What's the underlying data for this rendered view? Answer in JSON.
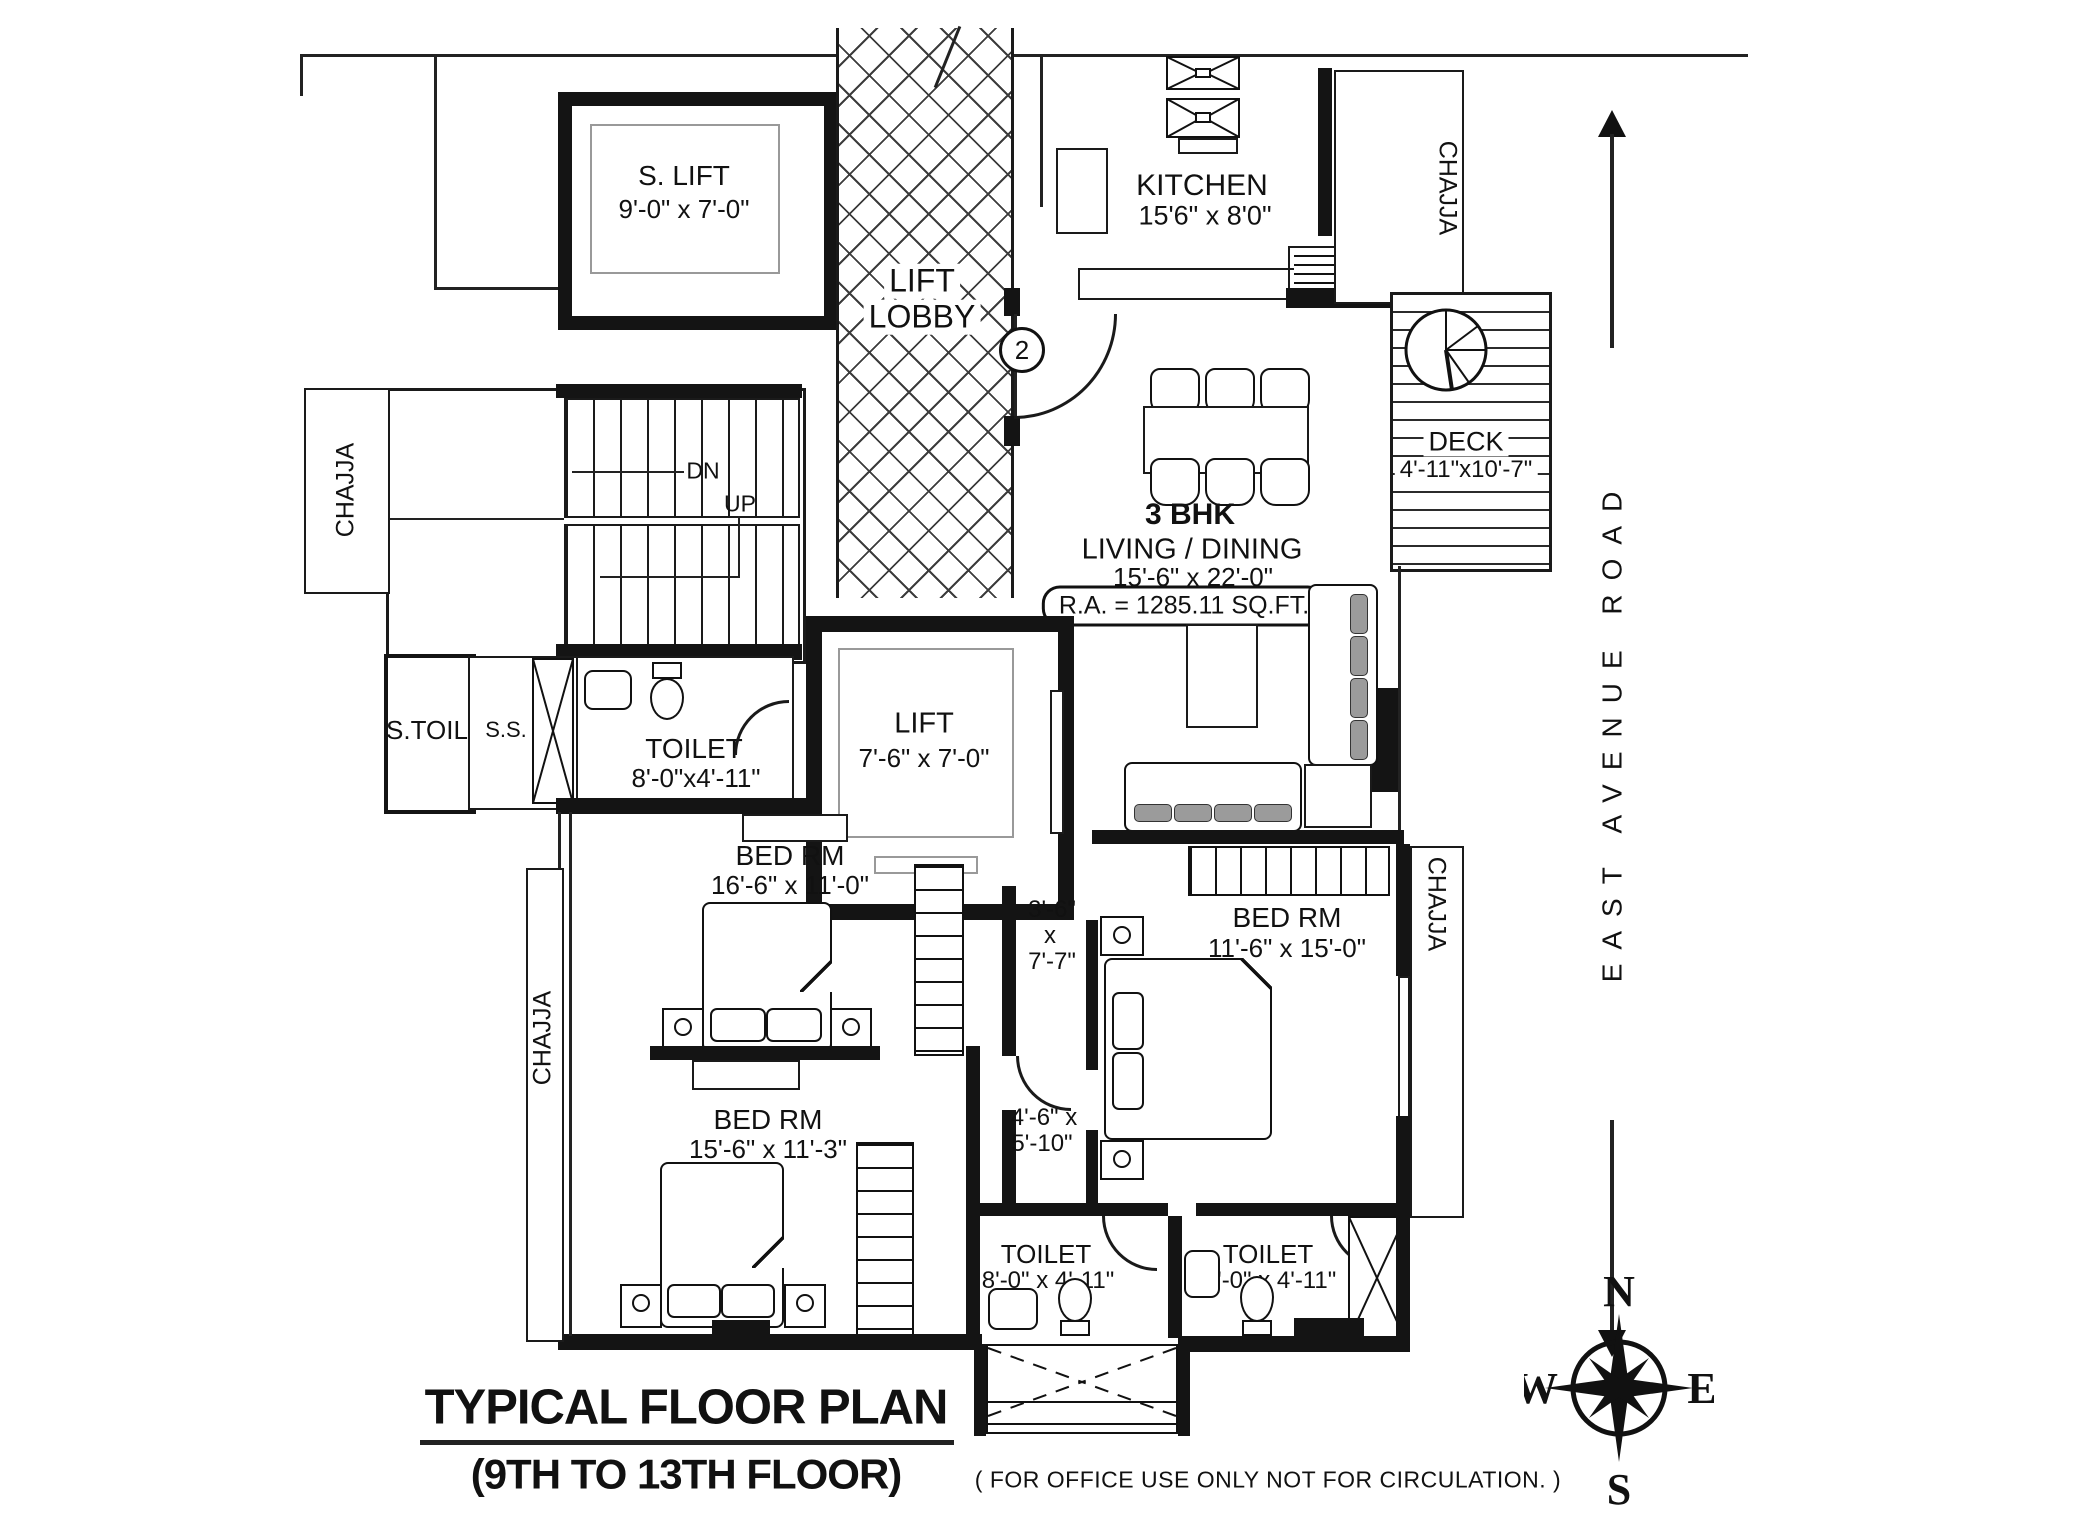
{
  "plan": {
    "s_lift": {
      "name": "S. LIFT",
      "dim": "9'-0\" x 7'-0\""
    },
    "lift_lobby": {
      "line1": "LIFT",
      "line2": "LOBBY"
    },
    "kitchen": {
      "name": "KITCHEN",
      "dim": "15'6\" x 8'0\""
    },
    "deck": {
      "name": "DECK",
      "dim": "4'-11\"x10'-7\""
    },
    "unit_type": "3 BHK",
    "living": {
      "name": "LIVING / DINING",
      "dim": "15'-6\" x 22'-0\"",
      "area": "R.A. = 1285.11 SQ.FT."
    },
    "lift": {
      "name": "LIFT",
      "dim": "7'-6\" x 7'-0\""
    },
    "toilet": {
      "name": "TOILET",
      "dim_mid": "8'-0\"x4'-11\"",
      "dim_small": "8'-0\" x 4'-11\""
    },
    "s_toil": "S.TOIL",
    "ss": "S.S.",
    "bed": {
      "name": "BED RM",
      "dim1": "16'-6\" x 11'-0\"",
      "dim2": "11'-6\" x 15'-0\"",
      "dim3": "15'-6\" x 11'-3\""
    },
    "passage1": {
      "l1": "3'-6\"",
      "l2": "x",
      "l3": "7'-7\""
    },
    "passage2": {
      "l1": "4'-6\" x",
      "l2": "5'-10\""
    },
    "stairs": {
      "dn": "DN",
      "up": "UP"
    },
    "chajja": "CHAJJA",
    "door_tag": "2"
  },
  "road": {
    "label": "EAST AVENUE ROAD"
  },
  "compass": {
    "n": "N",
    "e": "E",
    "s": "S",
    "w": "W"
  },
  "footer": {
    "title": "TYPICAL FLOOR PLAN",
    "subtitle": "(9TH TO 13TH FLOOR)",
    "note": "( FOR OFFICE USE ONLY NOT FOR CIRCULATION. )"
  }
}
